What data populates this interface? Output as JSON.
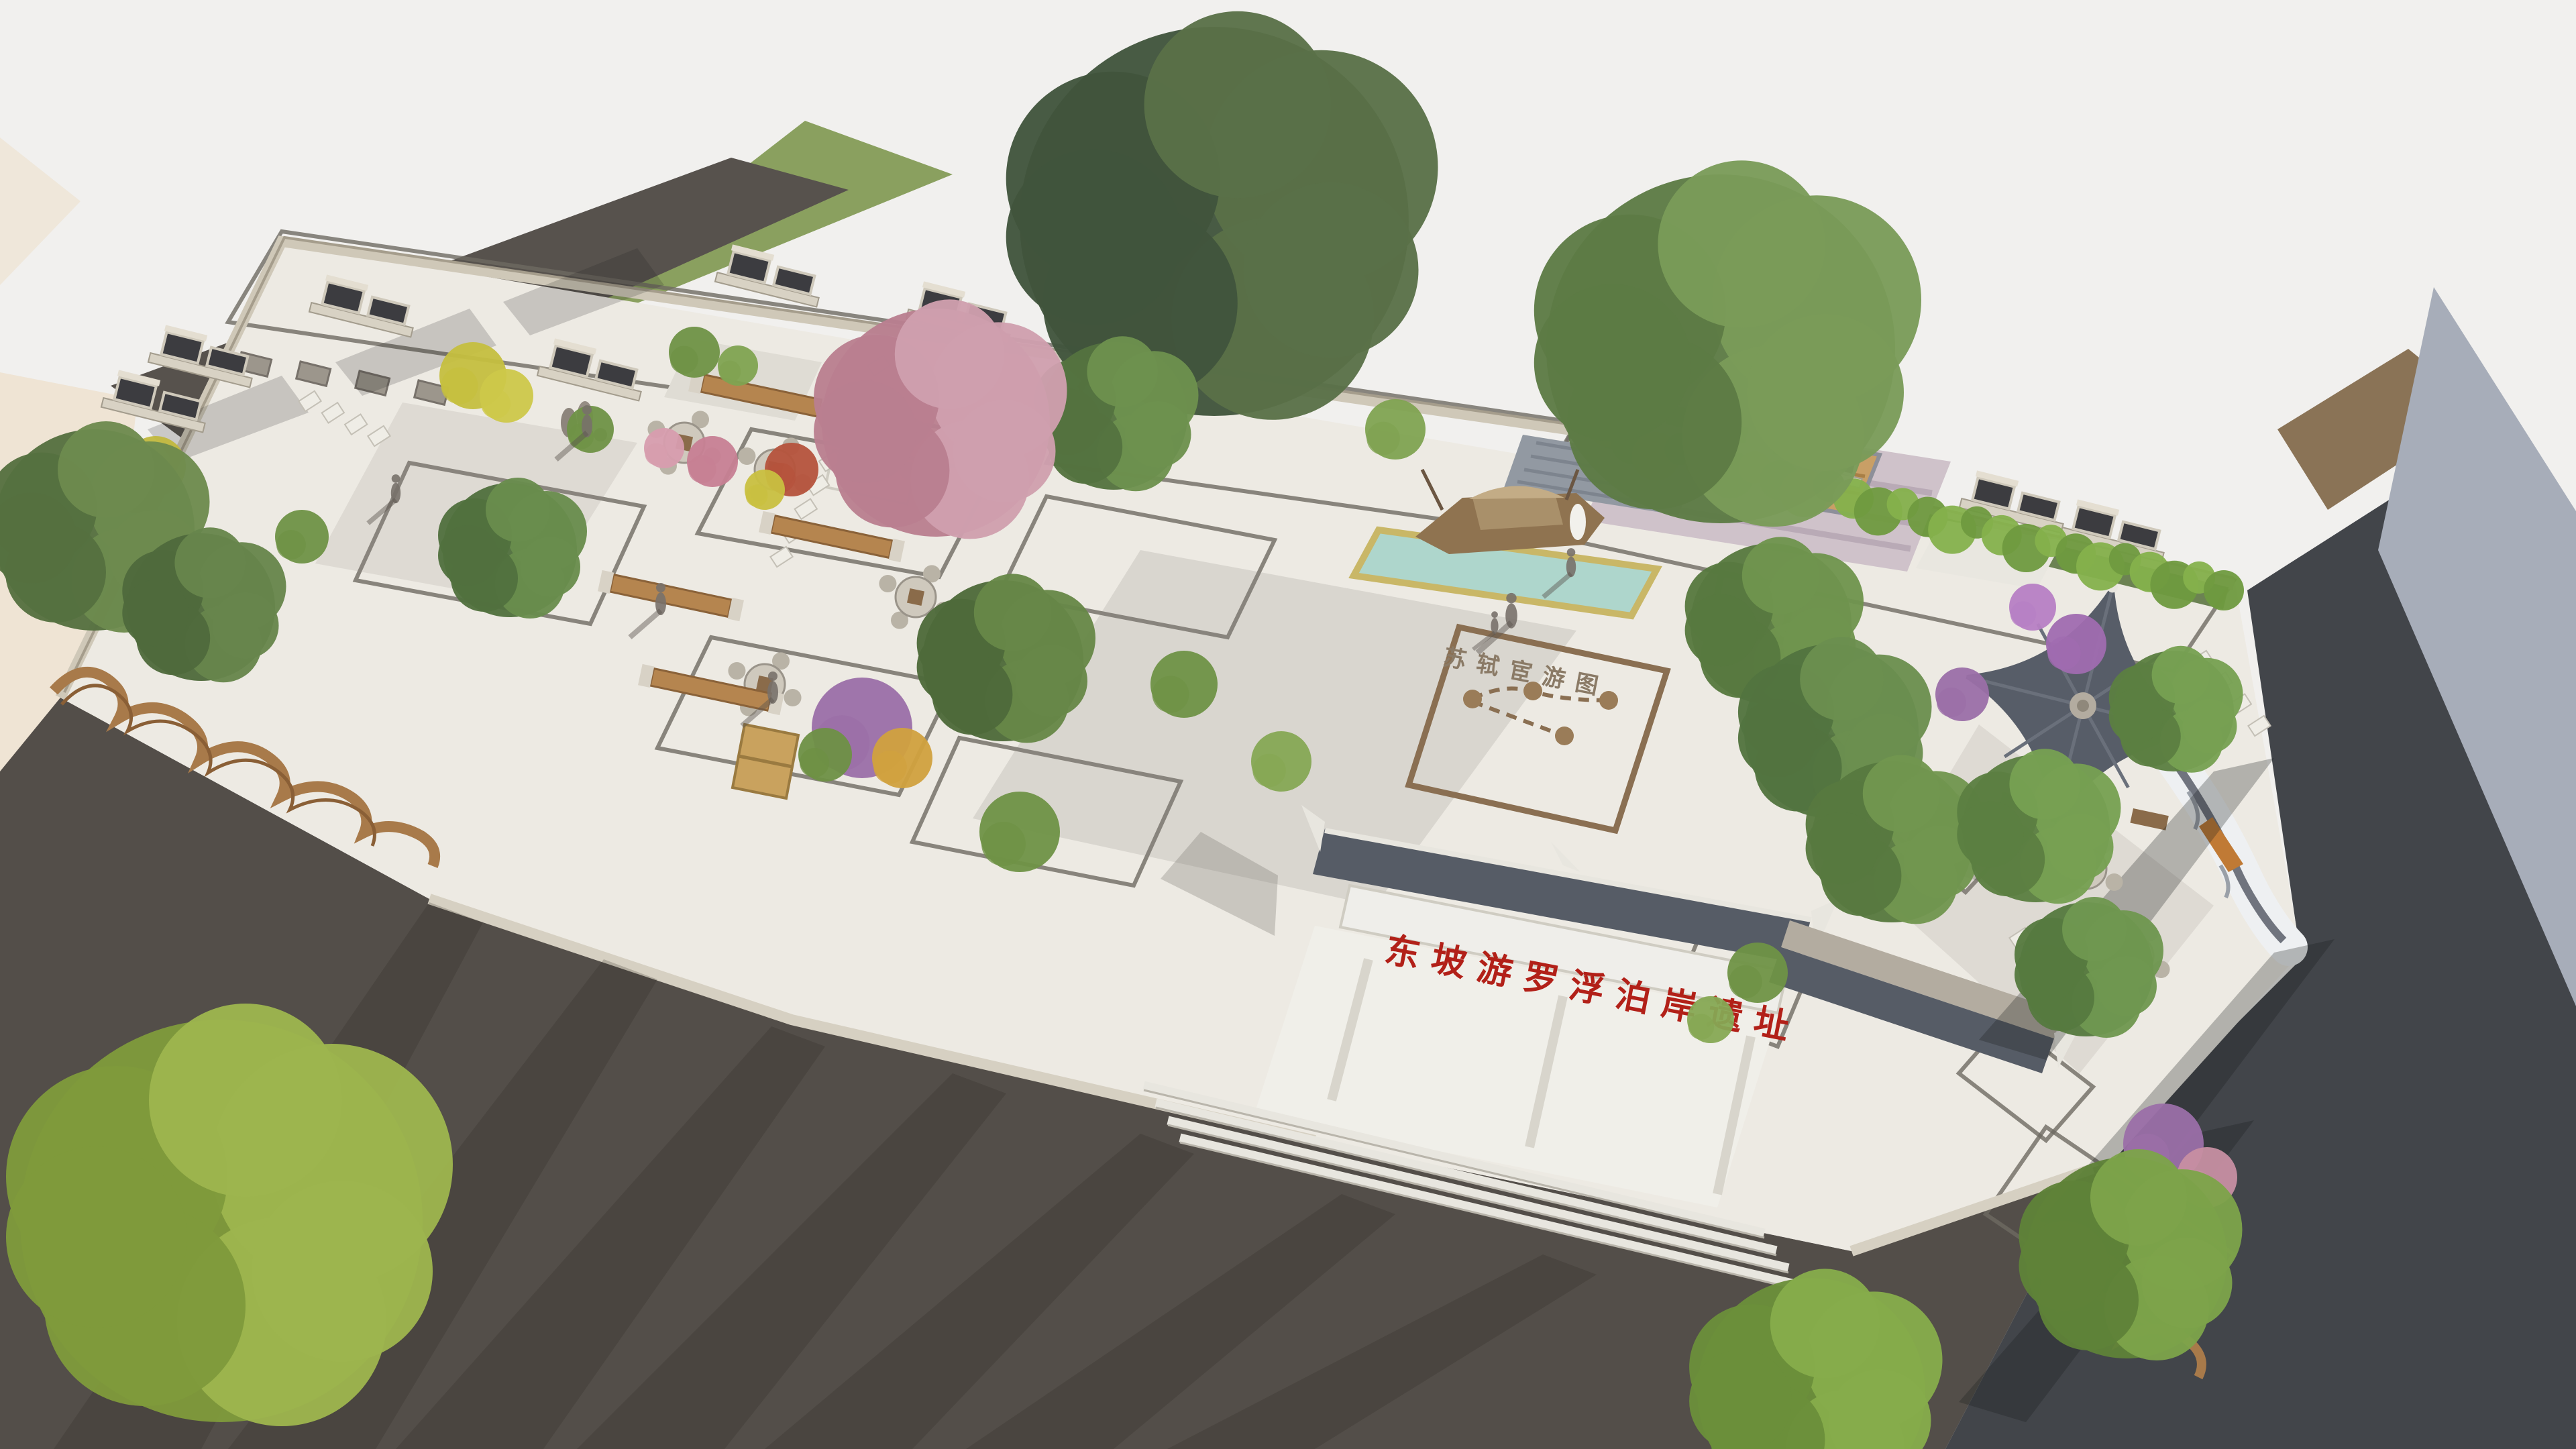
{
  "scene": {
    "description": "Aerial 3D landscape rendering of a heritage park with memorial gateway, pavilion, boat sculpture pool and gardens",
    "gate_inscription": "东坡游罗浮泊岸遗址",
    "ground_map_label": "苏轼宦游图"
  },
  "palette": {
    "sky": "#f1f0ee",
    "paving_light": "#edeae3",
    "lawn_green": "#7d9b55",
    "meadow_green": "#8aa05f",
    "road_dark": "#534e49",
    "asphalt_right": "#42454a",
    "wall_stone": "#cfc8b8",
    "lattice_dark": "#3c3c40",
    "roof_gray": "#565c66",
    "wood_brown": "#a87a4a",
    "water_teal": "#aed6cc",
    "blossom_pink": "#b97f90",
    "bamboo_green": "#6f9a3f",
    "inscription_red": "#b22018",
    "building_cream": "#efe4d4",
    "building_gray": "#a7adb9",
    "dirt_brown": "#8a7356",
    "amphitheater_mauve": "#cfc2ca"
  }
}
